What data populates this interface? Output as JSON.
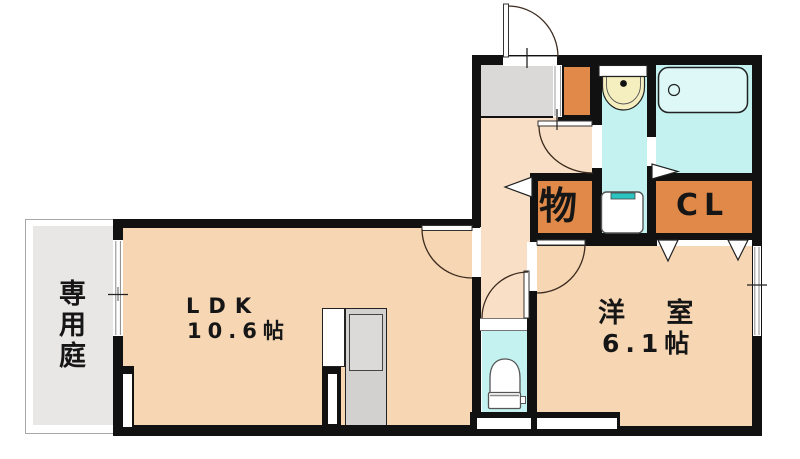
{
  "title": "apartment-floor-plan",
  "rooms": {
    "garden": {
      "label": "専用庭"
    },
    "ldk": {
      "name": "LDK",
      "size": "10.6帖"
    },
    "western": {
      "name": "洋 室",
      "size": "6.1帖"
    },
    "storage": {
      "name": "物"
    },
    "closet": {
      "name": "CL"
    }
  },
  "fixtures": [
    "entrance-door",
    "shoe-cabinet",
    "washbasin",
    "bathtub",
    "washing-machine-pan",
    "toilet",
    "kitchen-counter",
    "garden-sliding-window"
  ],
  "colors": {
    "wall": "#111111",
    "room_peach": "#f6d6b3",
    "hall_peach": "#f9dfc5",
    "wet_cyan": "#c3f2f0",
    "tub_cyan": "#ddf8f6",
    "closet_orange": "#e08948",
    "genkan_gray": "#dbd8d8",
    "garden_gray": "#e9e6e6",
    "kitchen_gray": "#d3d0d0",
    "basin_cream": "#f5efbf",
    "washer_teal": "#2cc4c0",
    "door_arc": "#3d2b1f"
  }
}
